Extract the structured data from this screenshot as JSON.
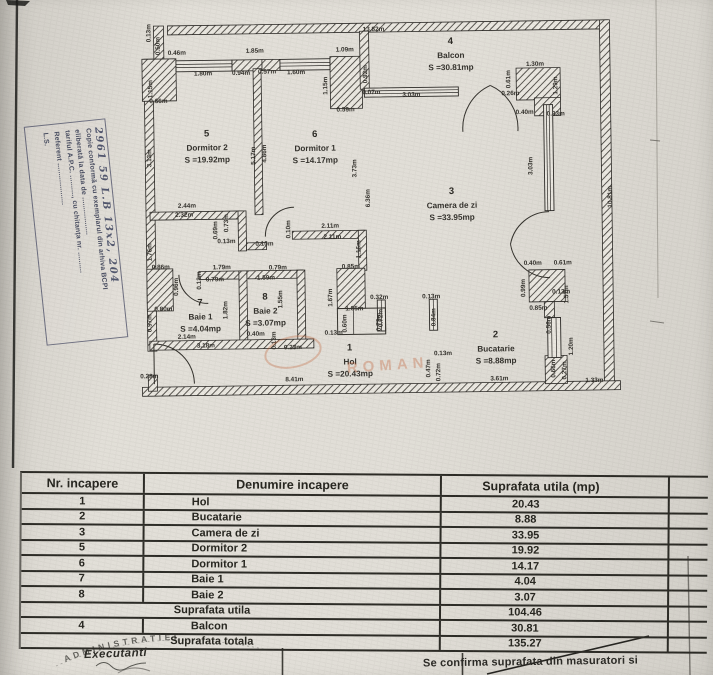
{
  "stamp_left": {
    "lines": [
      "2961 59 L.B  13x2, 204",
      "Copie conformă cu exemplarul din arhiva BCPI",
      "eliberată la data de ..................",
      "tariful A.P.C. .........., cu chitanța nr. ..........",
      "Referent ....................",
      "L.S."
    ]
  },
  "plan": {
    "rooms": [
      {
        "number": "5",
        "name": "Dormitor 2",
        "area": "S =19.92mp",
        "x": 208,
        "y": 134
      },
      {
        "number": "6",
        "name": "Dormitor 1",
        "area": "S =14.17mp",
        "x": 316,
        "y": 136
      },
      {
        "number": "4",
        "name": "Balcon",
        "area": "S =30.81mp",
        "x": 453,
        "y": 45
      },
      {
        "number": "3",
        "name": "Camera de zi",
        "area": "S =33.95mp",
        "x": 452,
        "y": 195
      },
      {
        "number": "2",
        "name": "Bucatarie",
        "area": "S =8.88mp",
        "x": 494,
        "y": 339
      },
      {
        "number": "7",
        "name": "Baie 1",
        "area": "S =4.04mp",
        "x": 199,
        "y": 303
      },
      {
        "number": "8",
        "name": "Baie 2",
        "area": "S =3.07mp",
        "x": 264,
        "y": 298
      },
      {
        "number": "1",
        "name": "Hol",
        "area": "S =20.43mp",
        "x": 348,
        "y": 350
      }
    ],
    "dimensions": [
      [
        "13.82m",
        376,
        31
      ],
      [
        "0.46m",
        179,
        52
      ],
      [
        "1.85m",
        257,
        51
      ],
      [
        "1.09m",
        347,
        51
      ],
      [
        "1.80m",
        205,
        73
      ],
      [
        "0.94m",
        243,
        73
      ],
      [
        "0.57m",
        269,
        72
      ],
      [
        "1.60m",
        298,
        73
      ],
      [
        "0.13m",
        153,
        30,
        1
      ],
      [
        "0.50m",
        162,
        43,
        1
      ],
      [
        "1.15m",
        154,
        86,
        1
      ],
      [
        "0.66m",
        160,
        100
      ],
      [
        "1.15m",
        329,
        85,
        1
      ],
      [
        "0.59m",
        347,
        111
      ],
      [
        "0.92m",
        369,
        74,
        1
      ],
      [
        "0.07m",
        373,
        94
      ],
      [
        "3.03m",
        413,
        97
      ],
      [
        "1.30m",
        537,
        68
      ],
      [
        "0.61m",
        512,
        81,
        1
      ],
      [
        "0.26m",
        512,
        97
      ],
      [
        "1.29m",
        559,
        88,
        1
      ],
      [
        "0.40m",
        526,
        116
      ],
      [
        "0.33m",
        557,
        118
      ],
      [
        "10.81m",
        612,
        200,
        1
      ],
      [
        "3.13m",
        152,
        155,
        1
      ],
      [
        "5.17m",
        256,
        154,
        1
      ],
      [
        "4.86m",
        267,
        152,
        1
      ],
      [
        "3.73m",
        357,
        168,
        1
      ],
      [
        "6.36m",
        370,
        198,
        1
      ],
      [
        "3.03m",
        533,
        168,
        1
      ],
      [
        "2.44m",
        187,
        205
      ],
      [
        "2.32m",
        184,
        214
      ],
      [
        "0.73m",
        228,
        221,
        1
      ],
      [
        "0.69m",
        217,
        228,
        1
      ],
      [
        "0.13m",
        226,
        241
      ],
      [
        "0.10m",
        264,
        244
      ],
      [
        "0.10m",
        290,
        228,
        1
      ],
      [
        "2.11m",
        330,
        227
      ],
      [
        "2.11m",
        332,
        238
      ],
      [
        "1.16m",
        360,
        249,
        1
      ],
      [
        "1.76m",
        151,
        249,
        1
      ],
      [
        "0.86m",
        160,
        266
      ],
      [
        "1.79m",
        221,
        267
      ],
      [
        "0.79m",
        277,
        268
      ],
      [
        "0.79m",
        214,
        279
      ],
      [
        "1.59m",
        265,
        278
      ],
      [
        "0.85m",
        350,
        268
      ],
      [
        "0.13m",
        200,
        278,
        1
      ],
      [
        "0.96m",
        177,
        284,
        1
      ],
      [
        "1.82m",
        226,
        308,
        1
      ],
      [
        "1.55m",
        281,
        298,
        1
      ],
      [
        "1.67m",
        331,
        297,
        1
      ],
      [
        "0.32m",
        378,
        299
      ],
      [
        "0.13m",
        430,
        299
      ],
      [
        "0.72m",
        381,
        318,
        1
      ],
      [
        "0.84m",
        434,
        318,
        1
      ],
      [
        "0.40m",
        532,
        267
      ],
      [
        "0.61m",
        562,
        267
      ],
      [
        "0.13m",
        560,
        296
      ],
      [
        "0.99m",
        524,
        290,
        1
      ],
      [
        "1.57m",
        567,
        297,
        1
      ],
      [
        "0.85m",
        537,
        312
      ],
      [
        "0.56m",
        549,
        327,
        1
      ],
      [
        "1.20m",
        571,
        349,
        1
      ],
      [
        "0.80m",
        162,
        308
      ],
      [
        "0.97m",
        150,
        320,
        1
      ],
      [
        "2.14m",
        185,
        336
      ],
      [
        "3.18m",
        204,
        345
      ],
      [
        "0.40m",
        254,
        334
      ],
      [
        "0.13m",
        274,
        339,
        1
      ],
      [
        "0.23m",
        291,
        348
      ],
      [
        "0.13m",
        332,
        334
      ],
      [
        "1.05m",
        353,
        310
      ],
      [
        "0.60m",
        345,
        323,
        1
      ],
      [
        "0.72m",
        379,
        322,
        1
      ],
      [
        "0.13m",
        441,
        356
      ],
      [
        "0.47m",
        428,
        369,
        1
      ],
      [
        "0.72m",
        438,
        373,
        1
      ],
      [
        "0.28m",
        147,
        375
      ],
      [
        "8.41m",
        292,
        380
      ],
      [
        "3.61m",
        497,
        382
      ],
      [
        "1.33m",
        592,
        385
      ],
      [
        "0.66m",
        553,
        371,
        1
      ],
      [
        "0.27m",
        564,
        373,
        1
      ]
    ]
  },
  "table": {
    "headers": [
      "Nr. incapere",
      "Denumire incapere",
      "Suprafata utila (mp)"
    ],
    "rows": [
      {
        "nr": "1",
        "name": "Hol",
        "area": "20.43"
      },
      {
        "nr": "2",
        "name": "Bucatarie",
        "area": "8.88"
      },
      {
        "nr": "3",
        "name": "Camera de zi",
        "area": "33.95"
      },
      {
        "nr": "5",
        "name": "Dormitor 2",
        "area": "19.92"
      },
      {
        "nr": "6",
        "name": "Dormitor 1",
        "area": "14.17"
      },
      {
        "nr": "7",
        "name": "Baie 1",
        "area": "4.04"
      },
      {
        "nr": "8",
        "name": "Baie 2",
        "area": "3.07"
      },
      {
        "nr": "",
        "name": "Suprafata utila",
        "area": "104.46",
        "summary": true
      },
      {
        "nr": "4",
        "name": "Balcon",
        "area": "30.81"
      },
      {
        "nr": "",
        "name": "Suprafata totala",
        "area": "135.27",
        "summary": true
      }
    ]
  },
  "footer": {
    "executant": "Executanti",
    "stamp_arc": "ADMINISTRATIEI",
    "confirm_line": "Se confirma suprafata din masuratori si"
  },
  "watermark": {
    "text": "ROMAN",
    "color": "#c0592b"
  }
}
